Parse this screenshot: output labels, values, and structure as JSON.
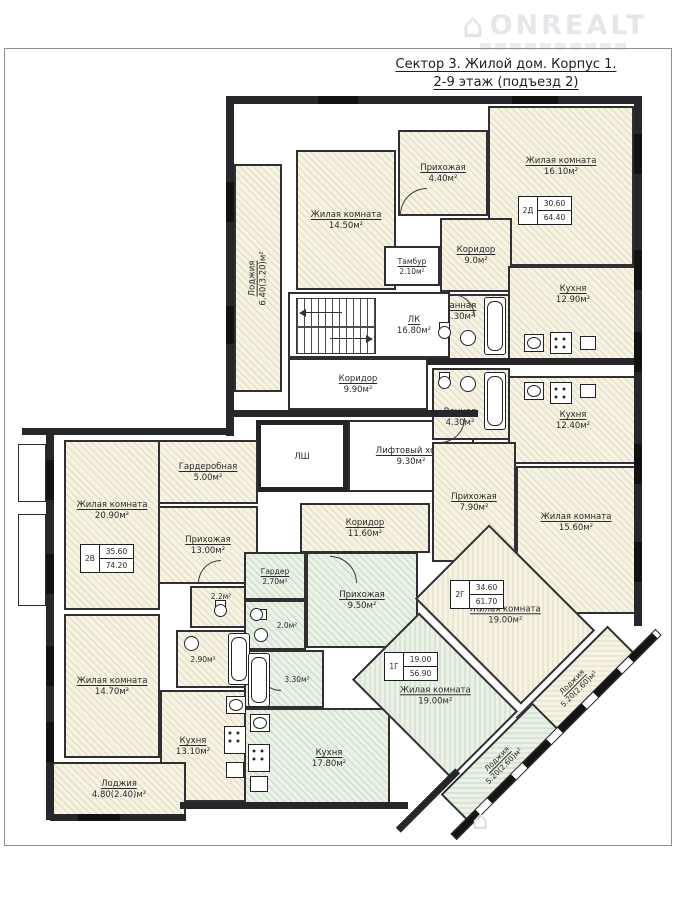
{
  "watermark": {
    "brand": "ONREALT"
  },
  "title": {
    "line1": "Сектор 3. Жилой дом. Корпус 1.",
    "line2": "2-9 этаж (подъезд 2)"
  },
  "apartments": {
    "a2d": {
      "id": "2Д",
      "living": "30.60",
      "total": "64.40"
    },
    "a2v": {
      "id": "2В",
      "living": "35.60",
      "total": "74.20"
    },
    "a2g": {
      "id": "2Г",
      "living": "34.60",
      "total": "61.70"
    },
    "a1g": {
      "id": "1Г",
      "living": "19.00",
      "total": "56.90"
    }
  },
  "rooms": {
    "lodzhiya_top": {
      "name": "Лоджия",
      "area": "6.40(3.20)м²"
    },
    "living_14_50": {
      "name": "Жилая комната",
      "area": "14.50м²"
    },
    "hall_4_40": {
      "name": "Прихожая",
      "area": "4.40м²"
    },
    "tambour": {
      "name": "Тамбур",
      "area": "2.10м²"
    },
    "living_16_10": {
      "name": "Жилая комната",
      "area": "16.10м²"
    },
    "corridor_9_0": {
      "name": "Коридор",
      "area": "9.0м²"
    },
    "bath_4_30_top": {
      "name": "Ванная",
      "area": "4.30м²"
    },
    "kitchen_12_90": {
      "name": "Кухня",
      "area": "12.90м²"
    },
    "lk": {
      "name": "ЛК",
      "area": "16.80м²"
    },
    "corridor_9_90": {
      "name": "Коридор",
      "area": "9.90м²"
    },
    "lsh": {
      "name": "ЛШ"
    },
    "lift_hall": {
      "name": "Лифтовый холл",
      "area": "9.30м²"
    },
    "bath_4_30_mid": {
      "name": "Ванная",
      "area": "4.30м²"
    },
    "kitchen_12_40": {
      "name": "Кухня",
      "area": "12.40м²"
    },
    "hall_7_90": {
      "name": "Прихожая",
      "area": "7.90м²"
    },
    "living_15_60": {
      "name": "Жилая комната",
      "area": "15.60м²"
    },
    "wardrobe_5_00": {
      "name": "Гардеробная",
      "area": "5.00м²"
    },
    "living_20_90": {
      "name": "Жилая комната",
      "area": "20.90м²"
    },
    "hall_13_00": {
      "name": "Прихожая",
      "area": "13.00м²"
    },
    "wc_2_2": {
      "area": "2.2м²"
    },
    "corridor_11_60": {
      "name": "Коридор",
      "area": "11.60м²"
    },
    "wardrobe_2_70": {
      "name": "Гардер",
      "area": "2.70м²"
    },
    "hall_9_50": {
      "name": "Прихожая",
      "area": "9.50м²"
    },
    "wc_2_0": {
      "area": "2.0м²"
    },
    "wc_2_90": {
      "area": "2.90м²"
    },
    "living_14_70": {
      "name": "Жилая комната",
      "area": "14.70м²"
    },
    "kitchen_13_10": {
      "name": "Кухня",
      "area": "13.10м²"
    },
    "bath_3_30": {
      "area": "3.30м²"
    },
    "kitchen_17_80": {
      "name": "Кухня",
      "area": "17.80м²"
    },
    "living_19_00_2g": {
      "name": "Жилая комната",
      "area": "19.00м²"
    },
    "living_19_00_1g": {
      "name": "Жилая комната",
      "area": "19.00м²"
    },
    "lodzhiya_4_80": {
      "name": "Лоджия",
      "area": "4.80(2.40)м²"
    },
    "lodzhiya_5_20_a": {
      "name": "Лоджия",
      "area": "5.20(2.60)м²"
    },
    "lodzhiya_5_20_b": {
      "name": "Лоджия",
      "area": "5.20(2.60)м²"
    }
  }
}
